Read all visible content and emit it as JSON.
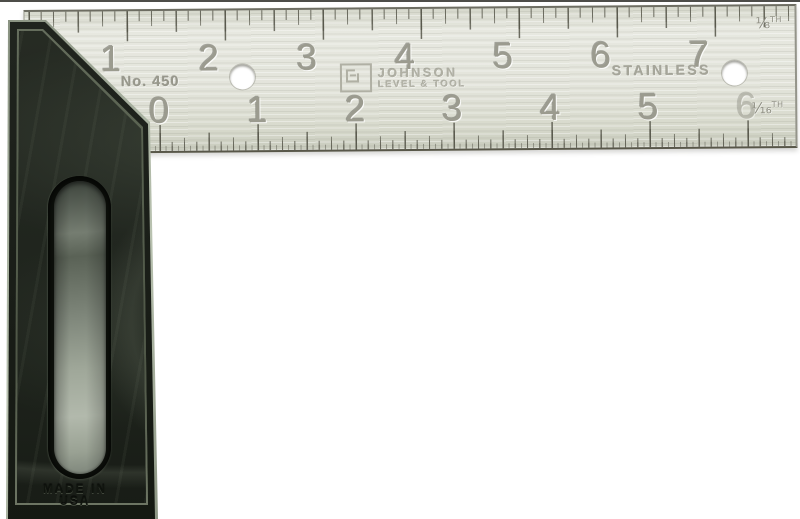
{
  "product": {
    "type_label": "try square",
    "model_label": "No. 450",
    "brand_line1": "JOHNSON",
    "brand_line2": "LEVEL & TOOL",
    "material_label": "STAINLESS",
    "origin_label": "MADE IN USA",
    "top_edge_fraction": "⅛",
    "bottom_edge_fraction": "¹⁄₁₆",
    "edge_suffix": "TH"
  },
  "ruler": {
    "top_numbers": [
      "1",
      "2",
      "3",
      "4",
      "5",
      "6",
      "7"
    ],
    "bottom_numbers": [
      "0",
      "1",
      "2",
      "3",
      "4",
      "5",
      "6"
    ]
  },
  "colors": {
    "background": "#ffffff",
    "blade_silver": "#e2e3da",
    "tick_gray": "#54544a",
    "engraving_gray": "#9b9b8f",
    "handle_black_green": "#20251e",
    "handle_highlight": "#b9c2b0"
  }
}
